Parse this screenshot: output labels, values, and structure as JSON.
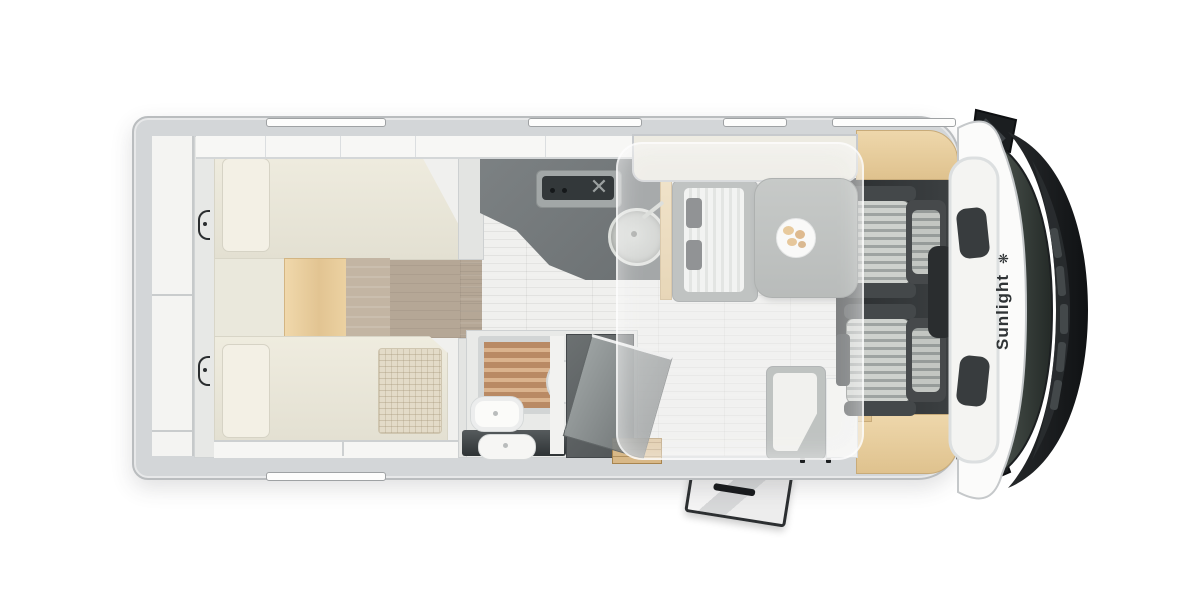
{
  "scene": {
    "description": "Top-down floor plan rendering of a Sunlight motorhome",
    "background_color": "#ffffff"
  },
  "branding": {
    "logo_text": "Sunlight",
    "logo_glyph": "❋",
    "logo_color": "#303436"
  },
  "palette": {
    "body_wall": "#d3d6d8",
    "interior_floor": "#f0f0ee",
    "mattress_cream": "#ebe8db",
    "wood_accent": "#e9cfa2",
    "wood_floor": "#ab9e8e",
    "kitchen_counter": "#73787a",
    "stove_top": "#33383a",
    "wardrobe_gray": "#5d6163",
    "shower_slats": "#b98a64",
    "table_gray": "#9aa09e",
    "cab_seat_bolster": "#44484a",
    "cab_seat_fabric": "#c9ccc8",
    "windshield_glass": "#3a423e",
    "hood_black": "#17191b",
    "dropdown_bed_overlay": "rgba(244,244,242,0.42)"
  },
  "icons": {
    "stove_grate": "✕"
  }
}
